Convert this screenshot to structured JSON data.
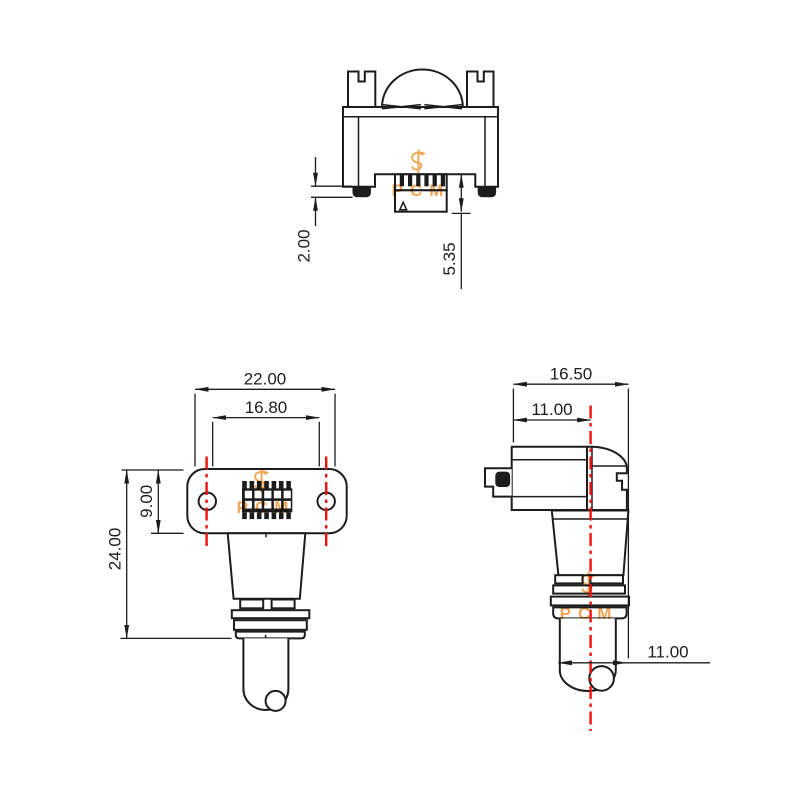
{
  "watermark": {
    "text": "PCM",
    "color": "#eda24b"
  },
  "colors": {
    "background": "#ffffff",
    "line": "#1c1c1c",
    "centerline": "#f01010"
  },
  "views": {
    "top": {
      "label": "top-view",
      "dims": {
        "foot_height": "2.00",
        "shroud_depth": "5.35"
      }
    },
    "front": {
      "label": "front-view",
      "dims": {
        "overall_width": "22.00",
        "inner_width": "16.80",
        "flange_height": "9.00",
        "body_height": "24.00"
      }
    },
    "side": {
      "label": "side-view",
      "dims": {
        "overall_depth": "16.50",
        "body_depth": "11.00",
        "cable_offset": "11.00"
      }
    }
  }
}
